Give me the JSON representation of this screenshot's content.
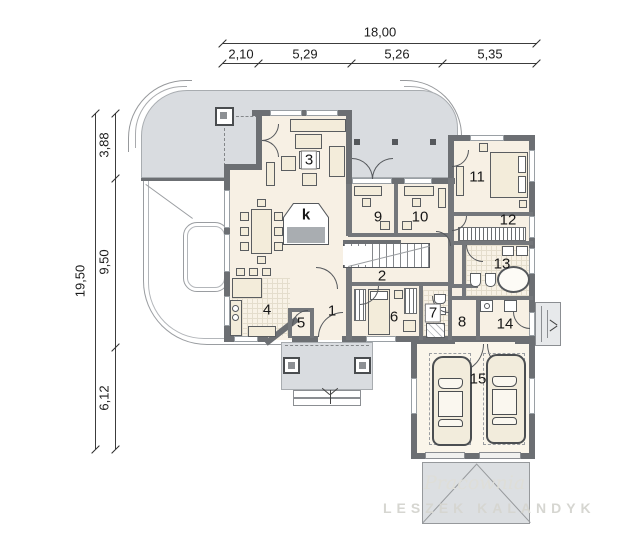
{
  "dimensions": {
    "top": {
      "total": "18,00",
      "segments": [
        "2,10",
        "5,29",
        "5,26",
        "5,35"
      ]
    },
    "left": {
      "total": "19,50",
      "segments": [
        "3,88",
        "9,50",
        "6,12"
      ]
    }
  },
  "rooms": {
    "r1": "1",
    "r2": "2",
    "r3": "3",
    "r4": "4",
    "r5": "5",
    "r6": "6",
    "r7": "7",
    "r8": "8",
    "r9": "9",
    "r10": "10",
    "r11": "11",
    "r12": "12",
    "r13": "13",
    "r14": "14",
    "r15": "15",
    "fireplace": "k"
  },
  "watermark": {
    "script": "Pracownia",
    "name": "LESZEK KALANDYK"
  },
  "colors": {
    "wall": "#6c6f73",
    "floor": "#f7f0e4",
    "terrace": "#d9dce0",
    "tile_line": "#e4ddcc",
    "dim_line": "#3c3c3c",
    "furniture": "#f3ecda"
  }
}
